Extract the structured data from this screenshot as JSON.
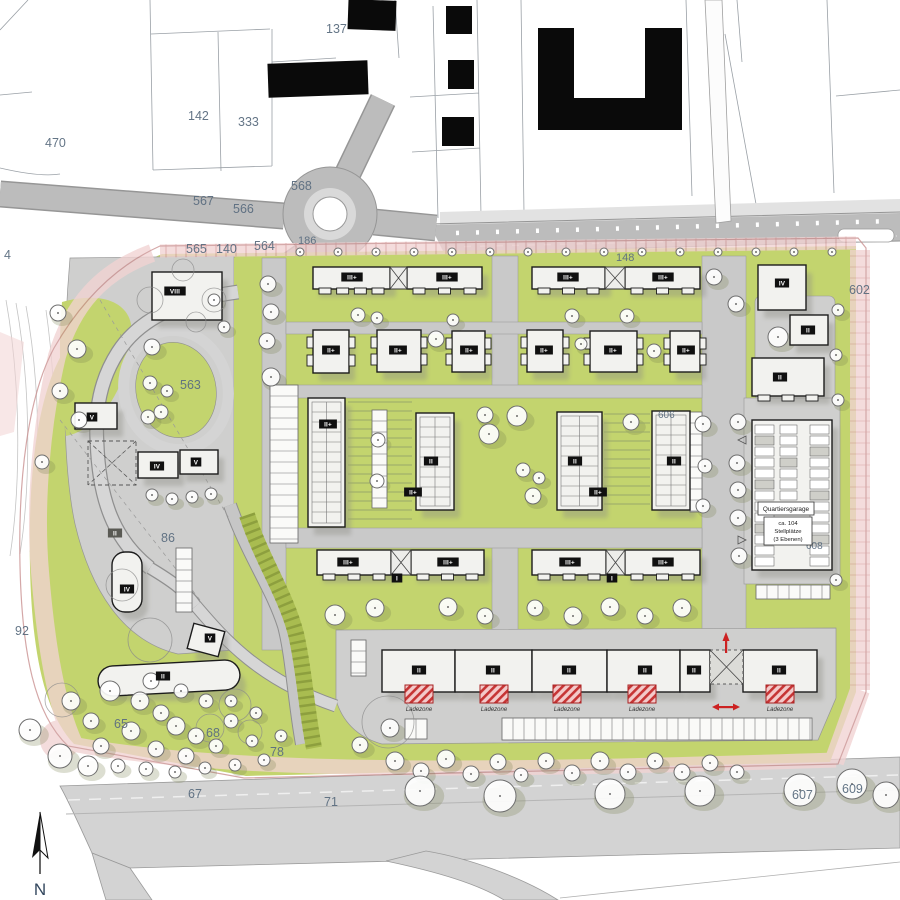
{
  "north_label": "N",
  "ladezone_label": "Ladezone",
  "garage": {
    "title": "Quartiersgarage",
    "capacity": "ca. 104",
    "unit": "Stellplätze",
    "levels": "(3 Ebenen)"
  },
  "colors": {
    "site_green": "#c3d46e",
    "road_gray": "#c9c9c9",
    "plaza_gray": "#cfcfce",
    "boundary_pink": "#f2d3d3",
    "accent_red": "#cc2a2a",
    "building_fill": "#f2f2ef",
    "existing_black": "#0a0a0a",
    "label_blue": "#5c6e80"
  },
  "parcels": [
    {
      "t": "470",
      "x": 45,
      "y": 147
    },
    {
      "t": "142",
      "x": 188,
      "y": 120
    },
    {
      "t": "333",
      "x": 238,
      "y": 126
    },
    {
      "t": "137",
      "x": 326,
      "y": 33
    },
    {
      "t": "567",
      "x": 193,
      "y": 205
    },
    {
      "t": "566",
      "x": 233,
      "y": 213
    },
    {
      "t": "568",
      "x": 291,
      "y": 190
    },
    {
      "t": "565",
      "x": 186,
      "y": 253
    },
    {
      "t": "140",
      "x": 216,
      "y": 253
    },
    {
      "t": "564",
      "x": 254,
      "y": 250
    },
    {
      "t": "186",
      "x": 298,
      "y": 244,
      "s": 11
    },
    {
      "t": "148",
      "x": 616,
      "y": 261,
      "s": 11
    },
    {
      "t": "4",
      "x": 4,
      "y": 259
    },
    {
      "t": "563",
      "x": 180,
      "y": 389
    },
    {
      "t": "86",
      "x": 161,
      "y": 542
    },
    {
      "t": "92",
      "x": 15,
      "y": 635
    },
    {
      "t": "602",
      "x": 849,
      "y": 294
    },
    {
      "t": "606",
      "x": 658,
      "y": 418,
      "s": 10
    },
    {
      "t": "608",
      "x": 806,
      "y": 549,
      "s": 10
    },
    {
      "t": "65",
      "x": 114,
      "y": 728
    },
    {
      "t": "68",
      "x": 206,
      "y": 737
    },
    {
      "t": "78",
      "x": 270,
      "y": 756
    },
    {
      "t": "67",
      "x": 188,
      "y": 798
    },
    {
      "t": "71",
      "x": 324,
      "y": 806
    },
    {
      "t": "607",
      "x": 792,
      "y": 799
    },
    {
      "t": "609",
      "x": 842,
      "y": 793
    }
  ],
  "badges": [
    {
      "t": "III+",
      "x": 352,
      "y": 277
    },
    {
      "t": "III+",
      "x": 447,
      "y": 277
    },
    {
      "t": "III+",
      "x": 568,
      "y": 277
    },
    {
      "t": "III+",
      "x": 663,
      "y": 277
    },
    {
      "t": "II+",
      "x": 331,
      "y": 350
    },
    {
      "t": "II+",
      "x": 398,
      "y": 350
    },
    {
      "t": "II+",
      "x": 469,
      "y": 350
    },
    {
      "t": "II+",
      "x": 544,
      "y": 350
    },
    {
      "t": "II+",
      "x": 613,
      "y": 350
    },
    {
      "t": "II+",
      "x": 686,
      "y": 350
    },
    {
      "t": "II+",
      "x": 328,
      "y": 424
    },
    {
      "t": "II",
      "x": 431,
      "y": 461
    },
    {
      "t": "II+",
      "x": 413,
      "y": 492
    },
    {
      "t": "II",
      "x": 575,
      "y": 461
    },
    {
      "t": "II+",
      "x": 598,
      "y": 492
    },
    {
      "t": "II",
      "x": 674,
      "y": 461
    },
    {
      "t": "III+",
      "x": 348,
      "y": 562
    },
    {
      "t": "III+",
      "x": 448,
      "y": 562
    },
    {
      "t": "III+",
      "x": 570,
      "y": 562
    },
    {
      "t": "III+",
      "x": 663,
      "y": 562
    },
    {
      "t": "I",
      "x": 397,
      "y": 578
    },
    {
      "t": "I",
      "x": 612,
      "y": 578
    },
    {
      "t": "II",
      "x": 419,
      "y": 670
    },
    {
      "t": "II",
      "x": 493,
      "y": 670
    },
    {
      "t": "II",
      "x": 569,
      "y": 670
    },
    {
      "t": "II",
      "x": 645,
      "y": 670
    },
    {
      "t": "II",
      "x": 694,
      "y": 670
    },
    {
      "t": "II",
      "x": 779,
      "y": 670
    },
    {
      "t": "VIII",
      "x": 175,
      "y": 291
    },
    {
      "t": "V",
      "x": 92,
      "y": 417
    },
    {
      "t": "IV",
      "x": 157,
      "y": 466
    },
    {
      "t": "V",
      "x": 196,
      "y": 462
    },
    {
      "t": "II",
      "x": 115,
      "y": 533,
      "gray": true
    },
    {
      "t": "IV",
      "x": 127,
      "y": 589
    },
    {
      "t": "V",
      "x": 210,
      "y": 638
    },
    {
      "t": "II",
      "x": 163,
      "y": 676
    },
    {
      "t": "IV",
      "x": 782,
      "y": 283
    },
    {
      "t": "II",
      "x": 808,
      "y": 330
    },
    {
      "t": "II",
      "x": 780,
      "y": 377
    }
  ],
  "buildings": [
    {
      "x": 313,
      "y": 267,
      "w": 77,
      "h": 22,
      "t": "teeth-b"
    },
    {
      "x": 407,
      "y": 267,
      "w": 75,
      "h": 22,
      "t": "teeth-b"
    },
    {
      "x": 532,
      "y": 267,
      "w": 73,
      "h": 22,
      "t": "teeth-b"
    },
    {
      "x": 625,
      "y": 267,
      "w": 75,
      "h": 22,
      "t": "teeth-b"
    },
    {
      "x": 390,
      "y": 267,
      "w": 17,
      "h": 22,
      "t": "conn"
    },
    {
      "x": 605,
      "y": 267,
      "w": 20,
      "h": 22,
      "t": "conn"
    },
    {
      "x": 313,
      "y": 330,
      "w": 36,
      "h": 43,
      "t": "teeth-lr"
    },
    {
      "x": 377,
      "y": 330,
      "w": 44,
      "h": 42,
      "t": "teeth-lr"
    },
    {
      "x": 452,
      "y": 331,
      "w": 33,
      "h": 41,
      "t": "teeth-lr"
    },
    {
      "x": 527,
      "y": 330,
      "w": 36,
      "h": 42,
      "t": "teeth-lr"
    },
    {
      "x": 590,
      "y": 331,
      "w": 47,
      "h": 41,
      "t": "teeth-lr"
    },
    {
      "x": 670,
      "y": 331,
      "w": 30,
      "h": 41,
      "t": "teeth-lr"
    },
    {
      "x": 308,
      "y": 398,
      "w": 37,
      "h": 129,
      "t": "cells"
    },
    {
      "x": 416,
      "y": 413,
      "w": 38,
      "h": 97,
      "t": "cells"
    },
    {
      "x": 557,
      "y": 412,
      "w": 45,
      "h": 98,
      "t": "cells"
    },
    {
      "x": 652,
      "y": 411,
      "w": 38,
      "h": 99,
      "t": "cells"
    },
    {
      "x": 317,
      "y": 550,
      "w": 74,
      "h": 25,
      "t": "teeth-b"
    },
    {
      "x": 411,
      "y": 550,
      "w": 73,
      "h": 25,
      "t": "teeth-b"
    },
    {
      "x": 532,
      "y": 550,
      "w": 74,
      "h": 25,
      "t": "teeth-b"
    },
    {
      "x": 625,
      "y": 550,
      "w": 75,
      "h": 25,
      "t": "teeth-b"
    },
    {
      "x": 391,
      "y": 550,
      "w": 20,
      "h": 25,
      "t": "conn"
    },
    {
      "x": 606,
      "y": 550,
      "w": 19,
      "h": 25,
      "t": "conn"
    },
    {
      "x": 382,
      "y": 650,
      "w": 73,
      "h": 42,
      "t": "plain"
    },
    {
      "x": 455,
      "y": 650,
      "w": 77,
      "h": 42,
      "t": "plain"
    },
    {
      "x": 532,
      "y": 650,
      "w": 75,
      "h": 42,
      "t": "plain"
    },
    {
      "x": 607,
      "y": 650,
      "w": 73,
      "h": 42,
      "t": "plain"
    },
    {
      "x": 680,
      "y": 650,
      "w": 30,
      "h": 42,
      "t": "plain"
    },
    {
      "x": 743,
      "y": 650,
      "w": 74,
      "h": 42,
      "t": "plain"
    },
    {
      "x": 710,
      "y": 650,
      "w": 33,
      "h": 34,
      "t": "xdash"
    },
    {
      "x": 152,
      "y": 272,
      "w": 70,
      "h": 48,
      "t": "plain"
    },
    {
      "x": 75,
      "y": 403,
      "w": 42,
      "h": 26,
      "t": "plain"
    },
    {
      "x": 138,
      "y": 452,
      "w": 40,
      "h": 26,
      "t": "plain"
    },
    {
      "x": 180,
      "y": 450,
      "w": 38,
      "h": 24,
      "t": "plain"
    },
    {
      "x": 112,
      "y": 552,
      "w": 30,
      "h": 60,
      "t": "plain",
      "rx": 13
    },
    {
      "x": 190,
      "y": 627,
      "w": 32,
      "h": 26,
      "t": "plain",
      "rot": 15
    },
    {
      "x": 98,
      "y": 663,
      "w": 142,
      "h": 30,
      "t": "plain",
      "rx": 15,
      "rot": -3
    },
    {
      "x": 88,
      "y": 441,
      "w": 48,
      "h": 44,
      "t": "dashed"
    },
    {
      "x": 758,
      "y": 265,
      "w": 48,
      "h": 45,
      "t": "plain"
    },
    {
      "x": 790,
      "y": 315,
      "w": 38,
      "h": 30,
      "t": "plain"
    },
    {
      "x": 752,
      "y": 358,
      "w": 72,
      "h": 38,
      "t": "teeth-b"
    },
    {
      "x": 752,
      "y": 420,
      "w": 80,
      "h": 150,
      "t": "garage"
    }
  ],
  "ladders": [
    [
      270,
      385,
      28,
      158,
      "v"
    ],
    [
      372,
      410,
      15,
      98,
      "v"
    ],
    [
      690,
      412,
      12,
      100,
      "v"
    ],
    [
      351,
      640,
      15,
      36,
      "v"
    ],
    [
      176,
      548,
      16,
      64,
      "v"
    ],
    [
      405,
      719,
      22,
      20,
      "h"
    ],
    [
      502,
      718,
      310,
      22,
      "h"
    ],
    [
      756,
      585,
      74,
      14,
      "h"
    ]
  ],
  "garden_stripes": [
    [
      348,
      402,
      64,
      122
    ],
    [
      604,
      414,
      46,
      94
    ]
  ],
  "ladezones": [
    [
      405,
      685,
      28,
      18
    ],
    [
      480,
      685,
      28,
      18
    ],
    [
      553,
      685,
      28,
      18
    ],
    [
      628,
      685,
      28,
      18
    ],
    [
      766,
      685,
      28,
      18
    ]
  ],
  "trees": [
    [
      300,
      252,
      4
    ],
    [
      338,
      252,
      4
    ],
    [
      376,
      252,
      4
    ],
    [
      414,
      252,
      4
    ],
    [
      452,
      252,
      4
    ],
    [
      490,
      252,
      4
    ],
    [
      528,
      252,
      4
    ],
    [
      566,
      252,
      4
    ],
    [
      604,
      252,
      4
    ],
    [
      642,
      252,
      4
    ],
    [
      680,
      252,
      4
    ],
    [
      718,
      252,
      4
    ],
    [
      756,
      252,
      4
    ],
    [
      794,
      252,
      4
    ],
    [
      832,
      252,
      4
    ],
    [
      268,
      284,
      8
    ],
    [
      271,
      312,
      8
    ],
    [
      267,
      341,
      8
    ],
    [
      271,
      377,
      9
    ],
    [
      58,
      313,
      8
    ],
    [
      77,
      349,
      9
    ],
    [
      152,
      347,
      8
    ],
    [
      60,
      391,
      8
    ],
    [
      79,
      420,
      8
    ],
    [
      148,
      417,
      7
    ],
    [
      42,
      462,
      7
    ],
    [
      150,
      383,
      7
    ],
    [
      167,
      391,
      6
    ],
    [
      161,
      412,
      7
    ],
    [
      214,
      300,
      6
    ],
    [
      224,
      327,
      6
    ],
    [
      152,
      495,
      6
    ],
    [
      172,
      499,
      6
    ],
    [
      192,
      497,
      6
    ],
    [
      211,
      494,
      6
    ],
    [
      485,
      415,
      8
    ],
    [
      517,
      416,
      10
    ],
    [
      489,
      434,
      10
    ],
    [
      523,
      470,
      7
    ],
    [
      539,
      478,
      6
    ],
    [
      533,
      496,
      8
    ],
    [
      631,
      422,
      8
    ],
    [
      703,
      424,
      8
    ],
    [
      705,
      466,
      7
    ],
    [
      703,
      506,
      7
    ],
    [
      378,
      440,
      7
    ],
    [
      377,
      481,
      7
    ],
    [
      358,
      315,
      7
    ],
    [
      377,
      318,
      6
    ],
    [
      436,
      339,
      8
    ],
    [
      453,
      320,
      6
    ],
    [
      572,
      316,
      7
    ],
    [
      627,
      316,
      7
    ],
    [
      581,
      344,
      6
    ],
    [
      654,
      351,
      7
    ],
    [
      714,
      277,
      8
    ],
    [
      736,
      304,
      8
    ],
    [
      778,
      337,
      10
    ],
    [
      738,
      422,
      8
    ],
    [
      737,
      463,
      8
    ],
    [
      738,
      490,
      8
    ],
    [
      738,
      518,
      8
    ],
    [
      739,
      556,
      8
    ],
    [
      838,
      310,
      6
    ],
    [
      836,
      355,
      6
    ],
    [
      838,
      400,
      6
    ],
    [
      836,
      580,
      6
    ],
    [
      335,
      615,
      10
    ],
    [
      375,
      608,
      9
    ],
    [
      448,
      607,
      9
    ],
    [
      485,
      616,
      8
    ],
    [
      535,
      608,
      8
    ],
    [
      573,
      616,
      9
    ],
    [
      610,
      607,
      9
    ],
    [
      645,
      616,
      8
    ],
    [
      682,
      608,
      9
    ],
    [
      395,
      761,
      9
    ],
    [
      421,
      771,
      8
    ],
    [
      446,
      759,
      9
    ],
    [
      471,
      774,
      8
    ],
    [
      498,
      762,
      8
    ],
    [
      521,
      775,
      7
    ],
    [
      546,
      761,
      8
    ],
    [
      572,
      773,
      8
    ],
    [
      600,
      761,
      9
    ],
    [
      628,
      772,
      8
    ],
    [
      655,
      761,
      8
    ],
    [
      682,
      772,
      8
    ],
    [
      710,
      763,
      8
    ],
    [
      737,
      772,
      7
    ],
    [
      390,
      728,
      9
    ],
    [
      360,
      745,
      8
    ],
    [
      420,
      791,
      15
    ],
    [
      500,
      796,
      16
    ],
    [
      610,
      794,
      15
    ],
    [
      700,
      791,
      15
    ],
    [
      800,
      790,
      16
    ],
    [
      852,
      784,
      15
    ],
    [
      886,
      795,
      13
    ],
    [
      60,
      756,
      12
    ],
    [
      88,
      766,
      10
    ],
    [
      30,
      730,
      11
    ],
    [
      110,
      691,
      10
    ],
    [
      140,
      701,
      9
    ],
    [
      161,
      713,
      8
    ],
    [
      176,
      726,
      9
    ],
    [
      196,
      736,
      8
    ],
    [
      131,
      731,
      9
    ],
    [
      101,
      746,
      8
    ],
    [
      156,
      749,
      8
    ],
    [
      186,
      756,
      8
    ],
    [
      216,
      746,
      7
    ],
    [
      231,
      721,
      7
    ],
    [
      252,
      741,
      6
    ],
    [
      151,
      681,
      8
    ],
    [
      181,
      691,
      7
    ],
    [
      206,
      701,
      7
    ],
    [
      231,
      701,
      6
    ],
    [
      256,
      713,
      6
    ],
    [
      281,
      736,
      6
    ],
    [
      91,
      721,
      8
    ],
    [
      71,
      701,
      9
    ],
    [
      118,
      766,
      7
    ],
    [
      146,
      769,
      7
    ],
    [
      175,
      772,
      6
    ],
    [
      205,
      768,
      6
    ],
    [
      235,
      765,
      6
    ],
    [
      264,
      760,
      6
    ]
  ]
}
